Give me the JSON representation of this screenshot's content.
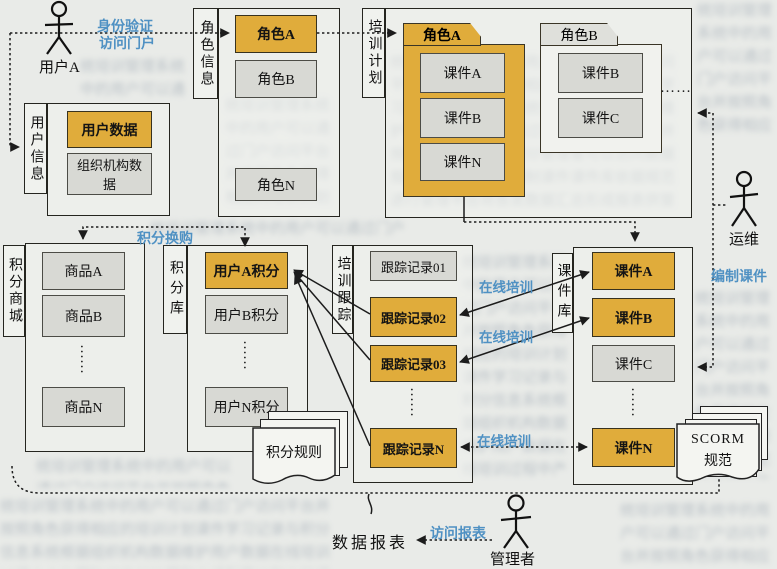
{
  "colors": {
    "highlight": "#e0ac3b",
    "gray_box": "#d8d9d4",
    "blue_text": "#4f91c3",
    "line": "#1c1c1c",
    "page_bg": "#e9ebe8"
  },
  "actors": {
    "user_a": "用户A",
    "ops": "运维",
    "manager": "管理者"
  },
  "edge_labels": {
    "auth_line1": "身份验证",
    "auth_line2": "访问门户",
    "points_exchange": "积分换购",
    "online_training": "在线培训",
    "compile_courseware": "编制课件",
    "access_report": "访问报表"
  },
  "captions": {
    "data_report": "数据报表"
  },
  "user_info": {
    "tab": "用户信息",
    "items": [
      {
        "label": "用户数据",
        "highlight": true
      },
      {
        "label": "组织机构数据",
        "highlight": false
      }
    ]
  },
  "role_info": {
    "tab": "角色信息",
    "items": [
      {
        "label": "角色A",
        "highlight": true
      },
      {
        "label": "角色B",
        "highlight": false
      },
      {
        "label": "角色N",
        "highlight": false
      }
    ]
  },
  "training_plan": {
    "tab": "培训计划"
  },
  "role_packages": {
    "folder_a": {
      "title": "角色A",
      "items": [
        "课件A",
        "课件B",
        "课件N"
      ]
    },
    "folder_b": {
      "title": "角色B",
      "items": [
        "课件B",
        "课件C"
      ]
    },
    "more": "……"
  },
  "points_mall": {
    "tab": "积分商城",
    "items": [
      "商品A",
      "商品B",
      "商品N"
    ],
    "more": "……"
  },
  "points_bank": {
    "tab": "积分库",
    "items": [
      {
        "label": "用户A积分",
        "highlight": true
      },
      {
        "label": "用户B积分",
        "highlight": false
      },
      {
        "label": "用户N积分",
        "highlight": false
      }
    ],
    "more": "……"
  },
  "points_rules": {
    "label": "积分规则"
  },
  "training_tracking": {
    "tab": "培训跟踪",
    "items": [
      {
        "label": "跟踪记录01",
        "highlight": false
      },
      {
        "label": "跟踪记录02",
        "highlight": true
      },
      {
        "label": "跟踪记录03",
        "highlight": true
      },
      {
        "label": "跟踪记录N",
        "highlight": true
      }
    ],
    "more": "……"
  },
  "courseware_lib": {
    "tab": "课件库",
    "items": [
      {
        "label": "课件A",
        "highlight": true
      },
      {
        "label": "课件B",
        "highlight": true
      },
      {
        "label": "课件C",
        "highlight": false
      },
      {
        "label": "课件N",
        "highlight": true
      }
    ],
    "more": "……"
  },
  "scorm": {
    "line1": "SCORM",
    "line2": "规范"
  },
  "page": {
    "bleed_filler": "统培训管理系统中的用户可以通过门户访问平台并按照角色获得相应的培训计划课件学习记录与积分信息系统根据组织机构数据维护用户数据在线培训过程中产生跟踪记录并按照积分规则累计积分管理者可以访问数据报表运维人员负责编制课件课件库依据规范进行管理平台将各类数据汇总形成报表供管理者查询使用系统培训管理中的用户可以通过门户访问平台并按照角色获得相应的培训计划课件学习记录与积分信息"
  }
}
